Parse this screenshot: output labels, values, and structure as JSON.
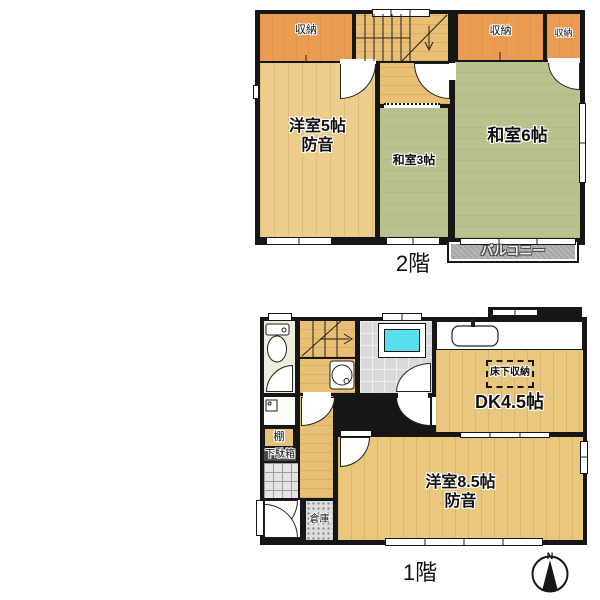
{
  "title": "apartment-floor-plan",
  "colors": {
    "wall": "#161616",
    "closet_orange": "#E99C52",
    "tatami_green": "#B8C28E",
    "wood_floor": "#EAC77E",
    "bathtub_cyan": "#58DFF0",
    "balcony_gray": "#A6A6A6",
    "background": "#FFFFFF"
  },
  "floor2": {
    "floor_label": "2階",
    "rooms": {
      "closet_tl": "収納",
      "closet_tr1": "収納",
      "closet_tr2": "収納",
      "western5_l1": "洋室5帖",
      "western5_l2": "防音",
      "japanese3": "和室3帖",
      "japanese6": "和室6帖",
      "balcony": "バルコニー"
    }
  },
  "floor1": {
    "floor_label": "1階",
    "rooms": {
      "underfloor_storage": "床下収納",
      "dk": "DK4.5帖",
      "western85_l1": "洋室8.5帖",
      "western85_l2": "防音",
      "shelf": "棚",
      "shoe_cabinet": "下駄箱",
      "storage": "倉庫"
    },
    "compass_n": "N"
  }
}
